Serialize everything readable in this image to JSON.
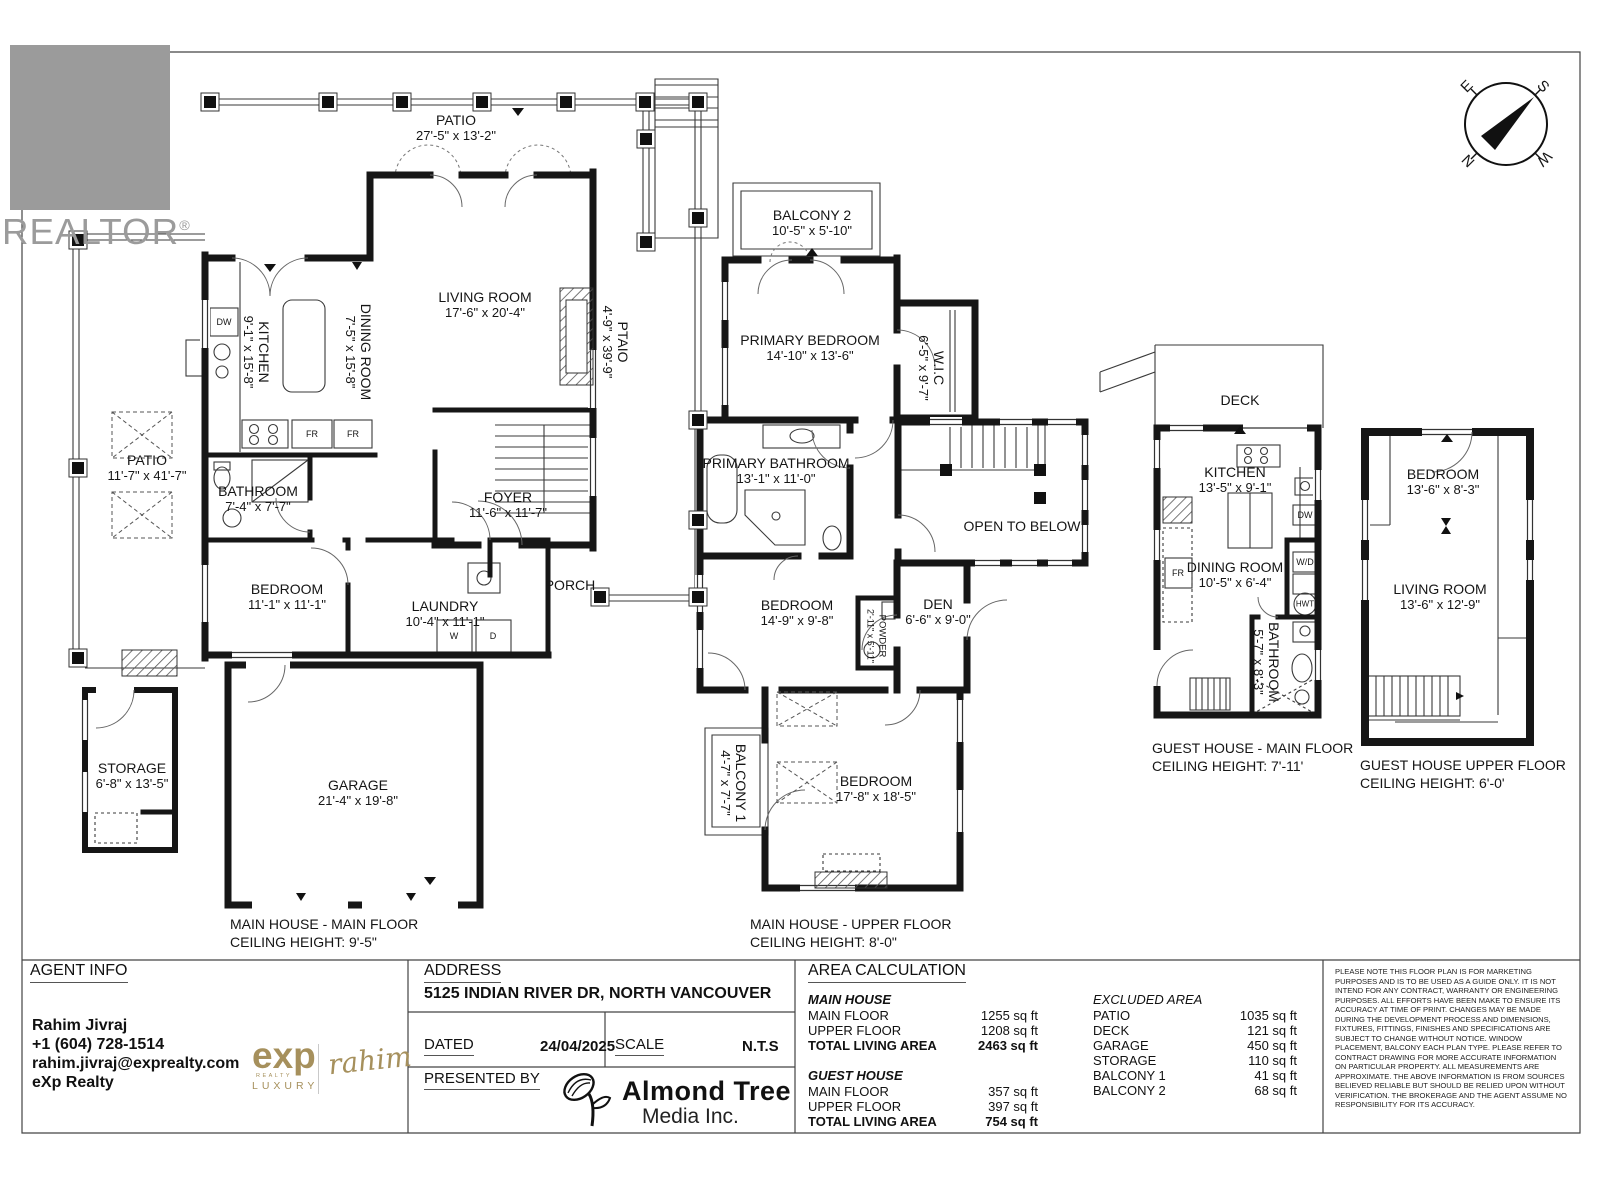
{
  "branding": {
    "realtor_word": "REALTOR",
    "registered": "®"
  },
  "compass": {
    "n": "N",
    "e": "E",
    "s": "S",
    "w": "W"
  },
  "fixtures": {
    "dw": "DW",
    "fr": "FR",
    "washer": "W",
    "dryer": "D",
    "wd": "W/D",
    "hwt": "HWT"
  },
  "plans": {
    "main_floor": {
      "caption1": "MAIN HOUSE - MAIN FLOOR",
      "caption2": "CEILING HEIGHT: 9'-5\"",
      "rooms": {
        "patio_top": {
          "name": "PATIO",
          "dims": "27'-5\" x 13'-2\""
        },
        "living": {
          "name": "LIVING ROOM",
          "dims": "17'-6\" x 20'-4\""
        },
        "kitchen": {
          "name": "KITCHEN",
          "dims": "9'-1\" x 15'-8\""
        },
        "dining": {
          "name": "DINING ROOM",
          "dims": "7'-5\" x 15'-8\""
        },
        "side_patio": {
          "name": "PTAIO",
          "dims": "4'-9\" x 39'-9\""
        },
        "left_patio": {
          "name": "PATIO",
          "dims": "11'-7\" x 41'-7\""
        },
        "bathroom": {
          "name": "BATHROOM",
          "dims": "7'-4\" x 7'-7\""
        },
        "foyer": {
          "name": "FOYER",
          "dims": "11'-6\" x 11'-7\""
        },
        "bedroom": {
          "name": "BEDROOM",
          "dims": "11'-1\" x 11'-1\""
        },
        "laundry": {
          "name": "LAUNDRY",
          "dims": "10'-4\" x 11'-1\""
        },
        "porch": {
          "name": "PORCH"
        },
        "storage": {
          "name": "STORAGE",
          "dims": "6'-8\" x 13'-5\""
        },
        "garage": {
          "name": "GARAGE",
          "dims": "21'-4\" x 19'-8\""
        }
      }
    },
    "upper_floor": {
      "caption1": "MAIN HOUSE - UPPER FLOOR",
      "caption2": "CEILING HEIGHT: 8'-0\"",
      "rooms": {
        "balcony2": {
          "name": "BALCONY 2",
          "dims": "10'-5\" x 5'-10\""
        },
        "primary_bedroom": {
          "name": "PRIMARY BEDROOM",
          "dims": "14'-10\" x 13'-6\""
        },
        "wic": {
          "name": "W.I.C",
          "dims": "6'-5\" x 9'-7\""
        },
        "primary_bathroom": {
          "name": "PRIMARY BATHROOM",
          "dims": "13'-1\" x 11'-0\""
        },
        "open_below": {
          "name": "OPEN TO BELOW"
        },
        "bedroom_mid": {
          "name": "BEDROOM",
          "dims": "14'-9\" x 9'-8\""
        },
        "den": {
          "name": "DEN",
          "dims": "6'-6\" x 9'-0\""
        },
        "powder": {
          "name": "POWDER",
          "dims": "2'-11\" x 5'-11\""
        },
        "balcony1": {
          "name": "BALCONY 1",
          "dims": "4'-7\" x 7'-7\""
        },
        "bedroom_big": {
          "name": "BEDROOM",
          "dims": "17'-8\" x 18'-5\""
        }
      }
    },
    "guest_main": {
      "caption1": "GUEST HOUSE - MAIN FLOOR",
      "caption2": "CEILING HEIGHT: 7'-11'",
      "rooms": {
        "deck": {
          "name": "DECK"
        },
        "kitchen": {
          "name": "KITCHEN",
          "dims": "13'-5\" x 9'-1\""
        },
        "dining": {
          "name": "DINING ROOM",
          "dims": "10'-5\" x 6'-4\""
        },
        "bathroom": {
          "name": "BATHROOM",
          "dims": "5'-7\" x 8'-3\""
        }
      }
    },
    "guest_upper": {
      "caption1": "GUEST HOUSE UPPER FLOOR",
      "caption2": "CEILING HEIGHT: 6'-0'",
      "rooms": {
        "bedroom": {
          "name": "BEDROOM",
          "dims": "13'-6\" x 8'-3\""
        },
        "living": {
          "name": "LIVING ROOM",
          "dims": "13'-6\" x 12'-9\""
        }
      }
    }
  },
  "footer": {
    "agent": {
      "title": "AGENT INFO",
      "name": "Rahim Jivraj",
      "phone": "+1 (604) 728-1514",
      "email": "rahim.jivraj@exprealty.com",
      "brokerage": "eXp Realty"
    },
    "exp": {
      "word": "exp",
      "realty": "REALTY",
      "luxury": "LUXURY",
      "signature": "rahim"
    },
    "address": {
      "title": "ADDRESS",
      "value": "5125 INDIAN RIVER DR, NORTH VANCOUVER"
    },
    "dated": {
      "label": "DATED",
      "value": "24/04/2025"
    },
    "scale_row": {
      "label": "SCALE",
      "value": "N.T.S"
    },
    "presented": {
      "label": "PRESENTED BY",
      "company1": "Almond Tree",
      "company2": "Media Inc."
    },
    "area": {
      "title": "AREA CALCULATION",
      "main_house": {
        "heading": "MAIN HOUSE",
        "rows": [
          {
            "label": "MAIN FLOOR",
            "value": "1255 sq ft"
          },
          {
            "label": "UPPER FLOOR",
            "value": "1208 sq ft"
          }
        ],
        "total": {
          "label": "TOTAL LIVING AREA",
          "value": "2463 sq ft"
        }
      },
      "guest_house": {
        "heading": "GUEST HOUSE",
        "rows": [
          {
            "label": "MAIN FLOOR",
            "value": "357 sq ft"
          },
          {
            "label": "UPPER FLOOR",
            "value": "397 sq ft"
          }
        ],
        "total": {
          "label": "TOTAL LIVING AREA",
          "value": "754 sq ft"
        }
      },
      "excluded": {
        "heading": "EXCLUDED AREA",
        "rows": [
          {
            "label": "PATIO",
            "value": "1035 sq ft"
          },
          {
            "label": "DECK",
            "value": "121 sq ft"
          },
          {
            "label": "GARAGE",
            "value": "450 sq ft"
          },
          {
            "label": "STORAGE",
            "value": "110 sq ft"
          },
          {
            "label": "BALCONY 1",
            "value": "41 sq ft"
          },
          {
            "label": "BALCONY 2",
            "value": "68 sq ft"
          }
        ]
      }
    },
    "disclaimer": "PLEASE NOTE THIS FLOOR PLAN IS FOR MARKETING PURPOSES AND IS TO BE USED AS A GUIDE ONLY. IT IS NOT INTEND FOR ANY CONTRACT, WARRANTY OR ENGINEERING PURPOSES. ALL EFFORTS HAVE BEEN MAKE TO ENSURE ITS ACCURACY AT TIME OF PRINT. CHANGES MAY BE MADE DURING THE DEVELOPMENT PROCESS AND DIMENSIONS, FIXTURES, FITTINGS, FINISHES AND SPECIFICATIONS ARE SUBJECT TO CHANGE WITHOUT NOTICE. WINDOW PLACEMENT, BALCONY EACH PLAN TYPE. PLEASE REFER TO CONTRACT DRAWING FOR MORE ACCURATE INFORMATION ON PARTICULAR PROPERTY. ALL MEASUREMENTS ARE APPROXIMATE. THE ABOVE INFORMATION IS FROM SOURCES BELIEVED RELIABLE BUT SHOULD BE RELIED UPON WITHOUT VERIFICATION. THE BROKERAGE AND THE AGENT ASSUME NO RESPONSIBILITY FOR ITS ACCURACY."
  }
}
